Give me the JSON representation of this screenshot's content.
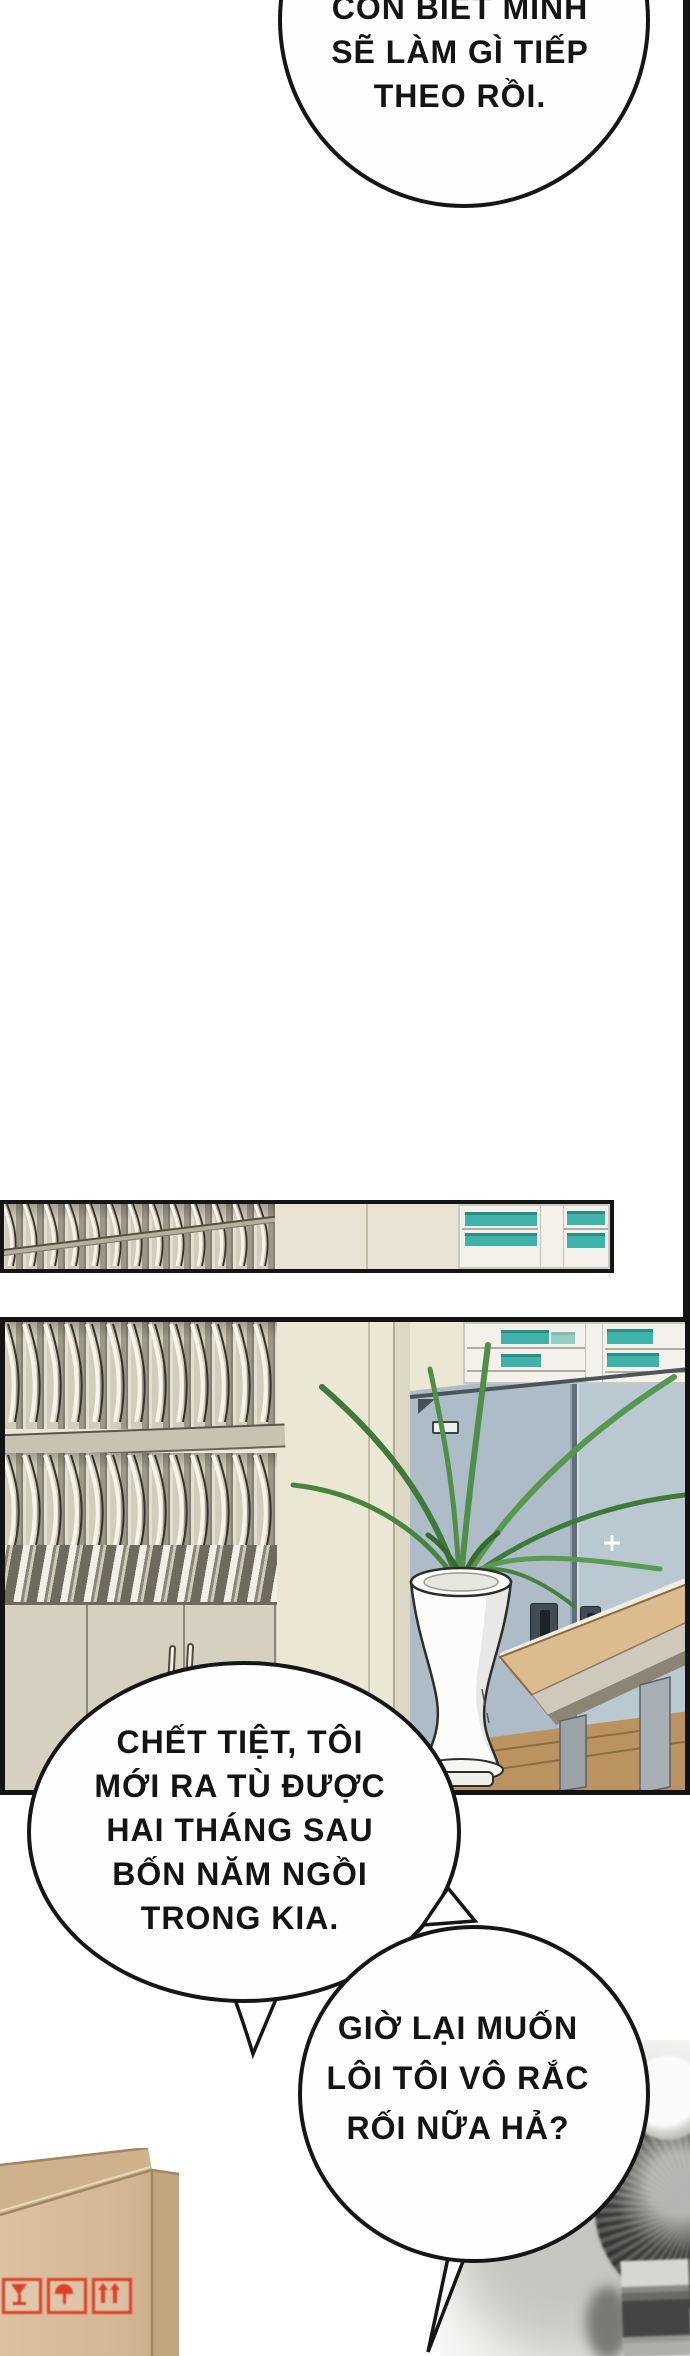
{
  "page": {
    "type": "comic-page"
  },
  "bubbles": {
    "top": {
      "lines": [
        "CÒN BIẾT MÌNH",
        "SẼ LÀM GÌ TIẾP",
        "THEO RỒI."
      ]
    },
    "prison": {
      "lines": [
        "CHẾT TIỆT, TÔI",
        "MỚI RA TÙ ĐƯỢC",
        "HAI THÁNG SAU",
        "BỐN NĂM NGỒI",
        "TRONG KIA."
      ]
    },
    "trouble": {
      "lines": [
        "GIỜ LẠI MUỐN",
        "LÔI TÔI VÔ RẮC",
        "RỐI NỮA HẢ?"
      ]
    }
  },
  "scene": {
    "panel_1": "shelf-strip-panel",
    "panel_2": "office-room-panel",
    "objects": [
      "mail-slot-shelves",
      "storage-cabinets",
      "binder-shelf",
      "locker-cabinet",
      "orchid-plant",
      "pedestal-vase",
      "wooden-desk",
      "wood-floor",
      "cardboard-box",
      "electric-fan-photo"
    ],
    "box_stamps": [
      {
        "icon": "fragile-glass-icon"
      },
      {
        "icon": "keep-dry-umbrella-icon"
      },
      {
        "icon": "this-side-up-arrows-icon"
      }
    ]
  },
  "colors": {
    "outline": "#1a1a1a",
    "teal_accent": "#41b2aa",
    "locker_blue": "#b6c4cd",
    "wall_beige": "#ece6d5",
    "shelf_beige": "#d2ccba",
    "desk_wood": "#dcbc8e",
    "floor_wood": "#bb9361",
    "box_tan": "#dabd9b",
    "stamp_red": "#dd3f27",
    "plant_green": "#4f8f49"
  }
}
